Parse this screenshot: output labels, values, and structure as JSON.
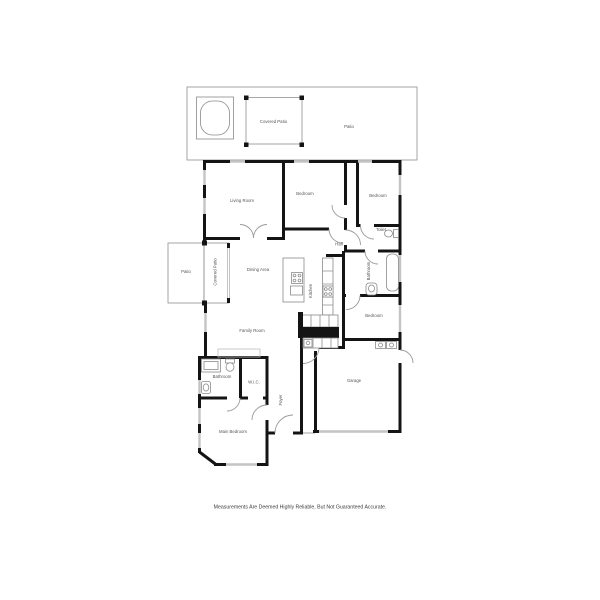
{
  "floorplan": {
    "disclaimer": "Measurements Are Deemed Highly Reliable, But Not Guaranteed Accurate.",
    "colors": {
      "wall": "#141414",
      "window": "#c4c4c4",
      "thin_line": "#909090",
      "label_text": "#555555",
      "disclaimer_text": "#3c3c3c",
      "background": "#ffffff"
    },
    "rooms": [
      {
        "id": "covered-patio-top",
        "label": "Covered Patio",
        "x": 273.5,
        "y": 123,
        "rot": 0
      },
      {
        "id": "patio-top",
        "label": "Patio",
        "x": 349,
        "y": 128,
        "rot": 0
      },
      {
        "id": "living-room",
        "label": "Living Room",
        "x": 242,
        "y": 202,
        "rot": 0
      },
      {
        "id": "bedroom-2",
        "label": "Bedroom",
        "x": 305,
        "y": 195,
        "rot": 0
      },
      {
        "id": "bedroom-3",
        "label": "Bedroom",
        "x": 378,
        "y": 197,
        "rot": 0
      },
      {
        "id": "hall",
        "label": "Hall",
        "x": 339,
        "y": 245.5,
        "rot": 0
      },
      {
        "id": "toilet",
        "label": "Toilet",
        "x": 381,
        "y": 231,
        "rot": 0
      },
      {
        "id": "bathroom-2",
        "label": "Bathroom",
        "x": 370,
        "y": 271,
        "rot": -90
      },
      {
        "id": "patio-left",
        "label": "Patio",
        "x": 186,
        "y": 273,
        "rot": 0
      },
      {
        "id": "covered-patio-left",
        "label": "Covered Patio",
        "x": 216.5,
        "y": 272,
        "rot": -90
      },
      {
        "id": "dining-area",
        "label": "Dining Area",
        "x": 258,
        "y": 271,
        "rot": 0
      },
      {
        "id": "kitchen",
        "label": "Kitchen",
        "x": 312,
        "y": 291,
        "rot": -90
      },
      {
        "id": "bedroom-4",
        "label": "Bedroom",
        "x": 374,
        "y": 317,
        "rot": 0
      },
      {
        "id": "family-room",
        "label": "Family Room",
        "x": 252,
        "y": 332,
        "rot": 0
      },
      {
        "id": "bathroom-1",
        "label": "Bathroom",
        "x": 222,
        "y": 378,
        "rot": 0
      },
      {
        "id": "wic",
        "label": "W.I.C.",
        "x": 254,
        "y": 383.5,
        "rot": 0
      },
      {
        "id": "foyer",
        "label": "Foyer",
        "x": 282,
        "y": 400,
        "rot": -90
      },
      {
        "id": "garage",
        "label": "Garage",
        "x": 354,
        "y": 382,
        "rot": 0
      },
      {
        "id": "main-bedroom",
        "label": "Main Bedroom",
        "x": 233,
        "y": 433,
        "rot": 0
      }
    ]
  }
}
